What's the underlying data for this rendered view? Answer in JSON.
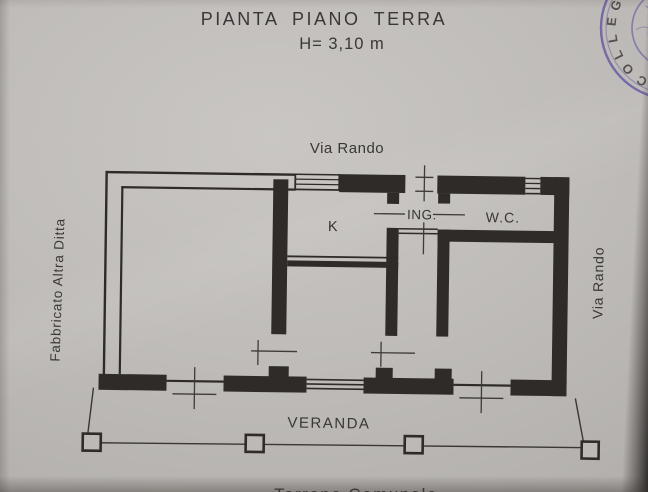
{
  "title": {
    "main": "PIANTA  PIANO  TERRA",
    "height_note": "H= 3,10 m"
  },
  "streets": {
    "top": "Via Rando",
    "right": "Via Rando"
  },
  "adjacent": {
    "left": "Fabbricato Altra Ditta",
    "bottom_partial": "Terreno Comunale"
  },
  "rooms": {
    "kitchen": "K",
    "entrance": "ING.",
    "wc": "W.C.",
    "veranda": "VERANDA"
  },
  "stamp": {
    "letters": [
      "C",
      "O",
      "L",
      "L",
      "E",
      "G"
    ],
    "ink_color": "#6456a2"
  },
  "colors": {
    "paper": "#bcb9b6",
    "ink": "#2e2b28",
    "label_text": "#3a3836"
  }
}
